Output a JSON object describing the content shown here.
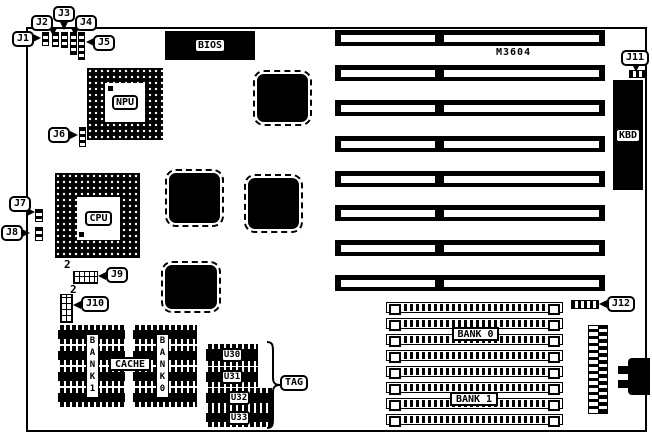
{
  "board": {
    "model": "M3604"
  },
  "callouts": {
    "j1": "J1",
    "j2": "J2",
    "j3": "J3",
    "j4": "J4",
    "j5": "J5",
    "j6": "J6",
    "j7": "J7",
    "j8": "J8",
    "j9": "J9",
    "j10": "J10",
    "j11": "J11",
    "j12": "J12"
  },
  "chips": {
    "bios": "BIOS",
    "npu": "NPU",
    "cpu": "CPU",
    "kbd": "KBD"
  },
  "memory": {
    "simm_bank0": "BANK 0",
    "simm_bank1": "BANK 1",
    "sram_bank1": "BANK1",
    "sram_bank0": "BANK0",
    "cache": "CACHE",
    "u30": "U30",
    "u31": "U31",
    "u32": "U32",
    "u33": "U33",
    "tag": "TAG"
  },
  "annotations": {
    "j9_pin2": "2",
    "j10_pin2": "2"
  }
}
